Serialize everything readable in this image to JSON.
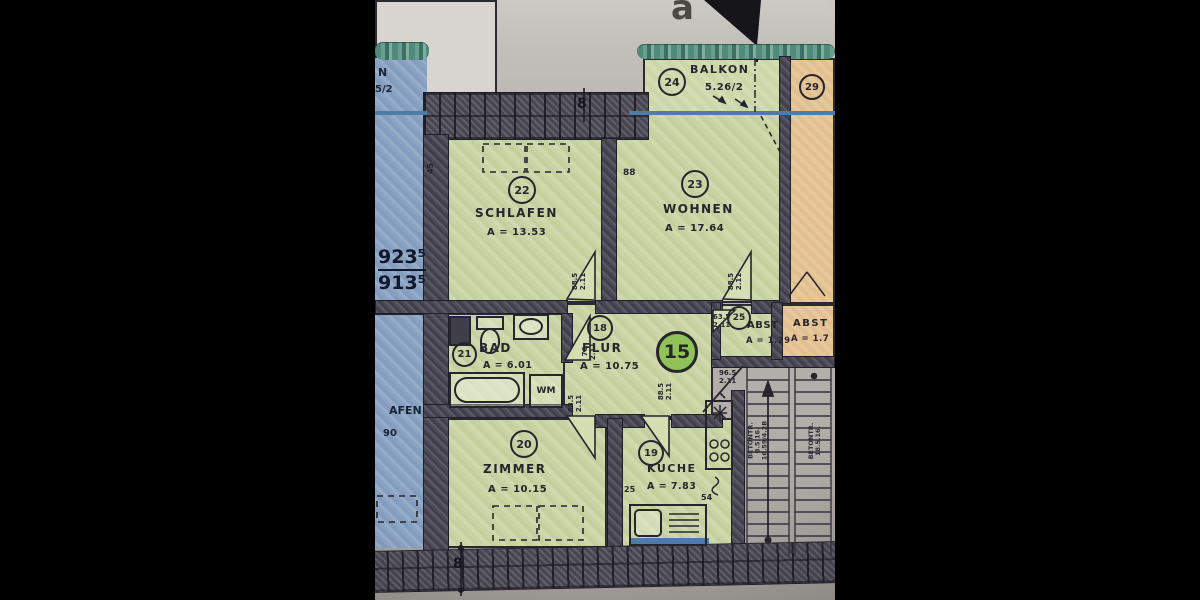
{
  "photo": {
    "north_glyph": "a",
    "section_top": "8",
    "section_bottom": "8"
  },
  "apartment": {
    "badge": "15",
    "rooms": {
      "schlafen": {
        "no": "22",
        "name": "SCHLAFEN",
        "area": "A = 13.53"
      },
      "wohnen": {
        "no": "23",
        "name": "WOHNEN",
        "area": "A = 17.64"
      },
      "balkon": {
        "no": "24",
        "name": "BALKON",
        "area": "5.26/2"
      },
      "bad": {
        "no": "21",
        "name": "BAD",
        "area": "A = 6.01"
      },
      "flur": {
        "no": "18",
        "name": "FLUR",
        "area": "A = 10.75"
      },
      "abst": {
        "no": "25",
        "name": "ABST",
        "area": "A = 1.29"
      },
      "zimmer": {
        "no": "20",
        "name": "ZIMMER",
        "area": "A = 10.15"
      },
      "kueche": {
        "no": "19",
        "name": "KUCHE",
        "area": "A = 7.83"
      }
    },
    "appliance_wm": "WM"
  },
  "neighbors": {
    "right_room_no": "29",
    "right_abst_name": "ABST",
    "right_abst_area": "A = 1.7",
    "left_balkon_text1": "N",
    "left_balkon_text2": "5/2",
    "left_dim_upper": "923⁵",
    "left_dim_lower": "913⁵",
    "left_room_fragment": "AFEN",
    "left_area_fragment": "90"
  },
  "dimensions": {
    "wall_88": "88",
    "wall_45": "45",
    "wall_25": "25",
    "wall_54": "54",
    "door_w_885": "88.5",
    "door_w_76": "76",
    "door_w_635": "63.5",
    "door_w_965": "96.5",
    "door_h_211": "2.11"
  },
  "stairs": {
    "left_line1": "BETONTR.",
    "left_line2": "B.5.16.",
    "left_line3": "16.59/4.2B",
    "right_line1": "BETONTR.",
    "right_line2": "18.5.16."
  }
}
